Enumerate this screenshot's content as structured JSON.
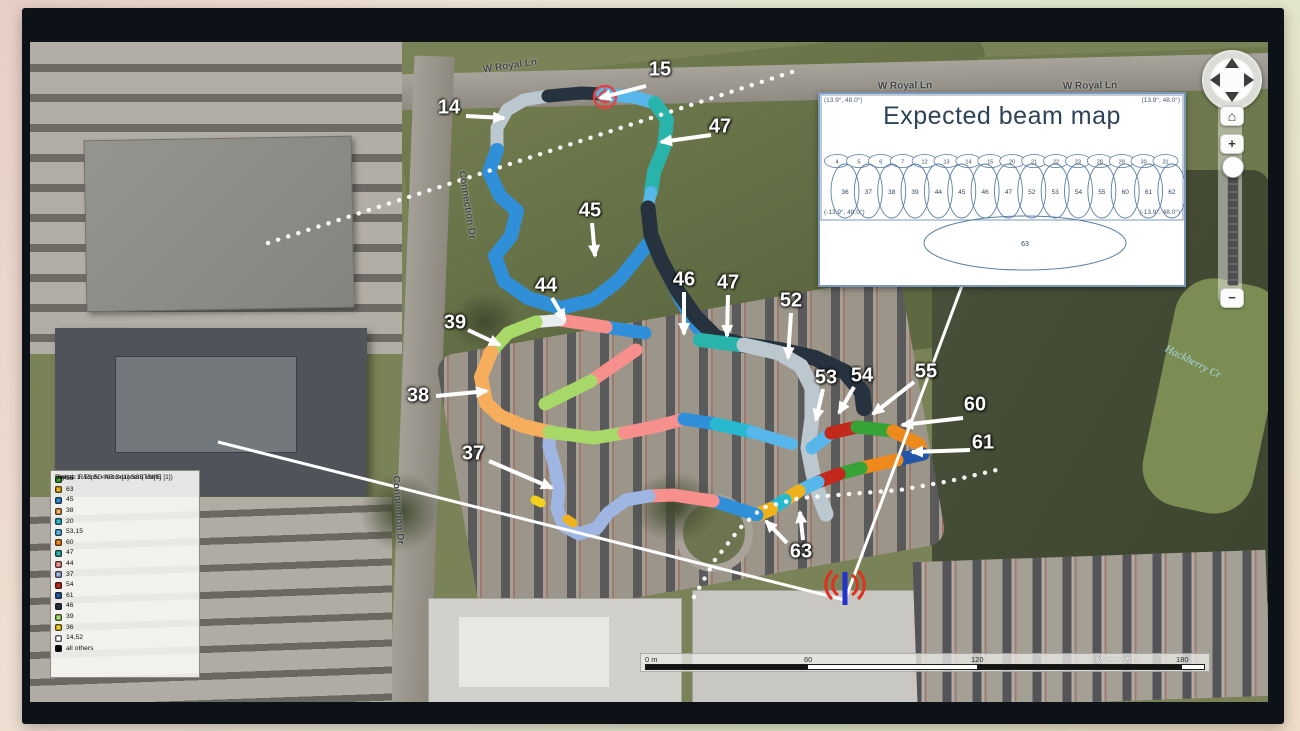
{
  "palette": {
    "b14_52": "#bcc8d0",
    "b15_53": "#58b7ea",
    "b45": "#2f8fd9",
    "b46": "#26323e",
    "b47": "#29b4ab",
    "b44": "#f78f8d",
    "b39": "#a8d968",
    "b38": "#f6ad5c",
    "b37": "#9fb6e3",
    "b54": "#c2291c",
    "b55": "#36a336",
    "b60": "#ee8a1b",
    "b61": "#2456a8",
    "b63": "#f0b21c",
    "b20": "#27b9d0",
    "b36": "#f2d21e",
    "white": "#e8edf0",
    "black": "#000000"
  },
  "legend": {
    "header_lines": [
      "Signal: 1. TopN <Auto>[1] SSB idx[1]",
      "Device: R&S 5G NR Scanner (TSME [1])",
      "Unit:"
    ],
    "entries": [
      {
        "label": "55",
        "color": "#36a336"
      },
      {
        "label": "63",
        "color": "#f0b21c"
      },
      {
        "label": "45",
        "color": "#2f8fd9"
      },
      {
        "label": "38",
        "color": "#f6ad5c"
      },
      {
        "label": "20",
        "color": "#27b9d0"
      },
      {
        "label": "53,15",
        "color": "#58b7ea"
      },
      {
        "label": "60",
        "color": "#ee8a1b"
      },
      {
        "label": "47",
        "color": "#29b4ab"
      },
      {
        "label": "44",
        "color": "#f78f8d"
      },
      {
        "label": "37",
        "color": "#9fb6e3"
      },
      {
        "label": "54",
        "color": "#c2291c"
      },
      {
        "label": "61",
        "color": "#2456a8"
      },
      {
        "label": "46",
        "color": "#26323e"
      },
      {
        "label": "39",
        "color": "#a8d968"
      },
      {
        "label": "36",
        "color": "#f2d21e"
      },
      {
        "label": "14,52",
        "color": "#ffffff"
      },
      {
        "label": "all others",
        "color": "#000000"
      }
    ]
  },
  "beam_map": {
    "title": "Expected beam map",
    "corner_labels": {
      "top_left": "(13.9°, 48.0°)",
      "top_right": "(13.9°, 48.0°)",
      "bottom_left": "(-13.9°, 48.0°)",
      "bottom_right": "(-13.9°, 48.0°)"
    },
    "row1": [
      "4",
      "5",
      "6",
      "7",
      "12",
      "13",
      "14",
      "15",
      "20",
      "21",
      "22",
      "23",
      "28",
      "29",
      "30",
      "31"
    ],
    "row2": [
      "36",
      "37",
      "38",
      "39",
      "44",
      "45",
      "46",
      "47",
      "52",
      "53",
      "54",
      "55",
      "60",
      "61",
      "62"
    ],
    "bottom_beam": "63"
  },
  "street_labels": [
    {
      "text": "W Royal Ln",
      "x": 480,
      "y": 24,
      "rot": -8,
      "style": ""
    },
    {
      "text": "W Royal Ln",
      "x": 875,
      "y": 44,
      "rot": -1,
      "style": ""
    },
    {
      "text": "W Royal Ln",
      "x": 1060,
      "y": 44,
      "rot": -1,
      "style": ""
    },
    {
      "text": "Connection Dr",
      "x": 437,
      "y": 163,
      "rot": 81,
      "style": ""
    },
    {
      "text": "Connection Dr",
      "x": 368,
      "y": 468,
      "rot": 86,
      "style": ""
    },
    {
      "text": "Hackberry Cr",
      "x": 1163,
      "y": 320,
      "rot": 27,
      "style": "creek"
    }
  ],
  "beam_labels": [
    {
      "text": "14",
      "x": 419,
      "y": 66,
      "arrows": [
        [
          436,
          74,
          474,
          76
        ]
      ]
    },
    {
      "text": "15",
      "x": 630,
      "y": 28,
      "arrows": [
        [
          616,
          44,
          570,
          56
        ]
      ]
    },
    {
      "text": "47",
      "x": 690,
      "y": 85,
      "arrows": [
        [
          681,
          93,
          631,
          100
        ]
      ]
    },
    {
      "text": "45",
      "x": 560,
      "y": 169,
      "arrows": [
        [
          562,
          181,
          565,
          214
        ]
      ]
    },
    {
      "text": "46",
      "x": 654,
      "y": 238,
      "arrows": [
        [
          654,
          250,
          654,
          292
        ]
      ]
    },
    {
      "text": "47",
      "x": 698,
      "y": 241,
      "arrows": [
        [
          698,
          253,
          697,
          294
        ]
      ]
    },
    {
      "text": "52",
      "x": 761,
      "y": 259,
      "arrows": [
        [
          761,
          271,
          758,
          316
        ]
      ]
    },
    {
      "text": "44",
      "x": 516,
      "y": 244,
      "arrows": [
        [
          522,
          256,
          535,
          278
        ]
      ]
    },
    {
      "text": "39",
      "x": 425,
      "y": 281,
      "arrows": [
        [
          438,
          288,
          470,
          303
        ]
      ]
    },
    {
      "text": "38",
      "x": 388,
      "y": 354,
      "arrows": [
        [
          406,
          354,
          457,
          349
        ]
      ]
    },
    {
      "text": "37",
      "x": 443,
      "y": 412,
      "arrows": [
        [
          459,
          419,
          522,
          446
        ]
      ]
    },
    {
      "text": "53",
      "x": 796,
      "y": 336,
      "arrows": [
        [
          793,
          347,
          786,
          378
        ]
      ]
    },
    {
      "text": "54",
      "x": 832,
      "y": 334,
      "arrows": [
        [
          824,
          345,
          809,
          371
        ]
      ]
    },
    {
      "text": "55",
      "x": 896,
      "y": 330,
      "arrows": [
        [
          884,
          340,
          843,
          372
        ]
      ]
    },
    {
      "text": "60",
      "x": 945,
      "y": 363,
      "arrows": [
        [
          933,
          376,
          872,
          383
        ]
      ]
    },
    {
      "text": "61",
      "x": 953,
      "y": 401,
      "arrows": [
        [
          940,
          408,
          882,
          410
        ]
      ]
    },
    {
      "text": "63",
      "x": 771,
      "y": 510,
      "arrows": [
        [
          757,
          501,
          736,
          479
        ],
        [
          773,
          498,
          770,
          470
        ]
      ]
    }
  ],
  "route_segments": [
    {
      "beam": "14",
      "c": "b14_52",
      "w": 13,
      "pts": [
        [
          467,
          108
        ],
        [
          467,
          86
        ],
        [
          477,
          68
        ],
        [
          494,
          58
        ],
        [
          518,
          54
        ]
      ]
    },
    {
      "beam": "46",
      "c": "b46",
      "w": 13,
      "pts": [
        [
          518,
          54
        ],
        [
          552,
          51
        ],
        [
          572,
          52
        ]
      ]
    },
    {
      "beam": "15",
      "c": "b15_53",
      "w": 13,
      "pts": [
        [
          572,
          52
        ],
        [
          604,
          55
        ],
        [
          625,
          61
        ]
      ]
    },
    {
      "beam": "47",
      "c": "b47",
      "w": 14,
      "pts": [
        [
          625,
          61
        ],
        [
          637,
          78
        ],
        [
          634,
          105
        ],
        [
          624,
          130
        ],
        [
          621,
          150
        ]
      ]
    },
    {
      "beam": "15",
      "c": "b15_53",
      "w": 12,
      "pts": [
        [
          621,
          150
        ],
        [
          618,
          164
        ]
      ]
    },
    {
      "beam": "45",
      "c": "b45",
      "w": 14,
      "pts": [
        [
          467,
          108
        ],
        [
          459,
          130
        ],
        [
          470,
          154
        ],
        [
          487,
          169
        ],
        [
          481,
          194
        ],
        [
          465,
          214
        ],
        [
          474,
          239
        ],
        [
          498,
          256
        ],
        [
          531,
          266
        ],
        [
          563,
          258
        ],
        [
          588,
          239
        ],
        [
          606,
          217
        ],
        [
          621,
          198
        ]
      ]
    },
    {
      "beam": "45",
      "c": "b45",
      "w": 14,
      "pts": [
        [
          621,
          198
        ],
        [
          635,
          226
        ],
        [
          651,
          258
        ],
        [
          668,
          286
        ],
        [
          684,
          298
        ]
      ]
    },
    {
      "beam": "46",
      "c": "b46",
      "w": 15,
      "pts": [
        [
          618,
          166
        ],
        [
          621,
          193
        ],
        [
          631,
          218
        ],
        [
          647,
          248
        ],
        [
          666,
          275
        ],
        [
          686,
          295
        ],
        [
          714,
          303
        ]
      ]
    },
    {
      "beam": "46",
      "c": "b46",
      "w": 16,
      "pts": [
        [
          714,
          303
        ],
        [
          750,
          308
        ],
        [
          785,
          316
        ],
        [
          815,
          330
        ],
        [
          832,
          350
        ],
        [
          834,
          366
        ]
      ]
    },
    {
      "beam": "47",
      "c": "b47",
      "w": 14,
      "pts": [
        [
          670,
          298
        ],
        [
          710,
          303
        ]
      ]
    },
    {
      "beam": "52",
      "c": "b14_52",
      "w": 15,
      "pts": [
        [
          714,
          303
        ],
        [
          749,
          311
        ],
        [
          771,
          324
        ],
        [
          782,
          346
        ],
        [
          782,
          376
        ],
        [
          778,
          406
        ],
        [
          783,
          432
        ],
        [
          790,
          456
        ],
        [
          796,
          472
        ]
      ]
    },
    {
      "beam": "53",
      "c": "b15_53",
      "w": 13,
      "pts": [
        [
          782,
          406
        ],
        [
          801,
          391
        ]
      ]
    },
    {
      "beam": "54",
      "c": "b54",
      "w": 13,
      "pts": [
        [
          801,
          391
        ],
        [
          827,
          385
        ]
      ]
    },
    {
      "beam": "55",
      "c": "b55",
      "w": 13,
      "pts": [
        [
          827,
          385
        ],
        [
          863,
          389
        ]
      ]
    },
    {
      "beam": "60",
      "c": "b60",
      "w": 13,
      "pts": [
        [
          863,
          389
        ],
        [
          889,
          402
        ],
        [
          893,
          412
        ]
      ]
    },
    {
      "beam": "61",
      "c": "b61",
      "w": 13,
      "pts": [
        [
          893,
          412
        ],
        [
          867,
          418
        ]
      ]
    },
    {
      "beam": "60",
      "c": "b60",
      "w": 13,
      "pts": [
        [
          867,
          418
        ],
        [
          831,
          426
        ]
      ]
    },
    {
      "beam": "55",
      "c": "b55",
      "w": 13,
      "pts": [
        [
          831,
          426
        ],
        [
          809,
          432
        ]
      ]
    },
    {
      "beam": "54",
      "c": "b54",
      "w": 13,
      "pts": [
        [
          809,
          432
        ],
        [
          788,
          440
        ]
      ]
    },
    {
      "beam": "53",
      "c": "b15_53",
      "w": 13,
      "pts": [
        [
          788,
          440
        ],
        [
          769,
          449
        ]
      ]
    },
    {
      "beam": "63",
      "c": "b63",
      "w": 13,
      "pts": [
        [
          769,
          449
        ],
        [
          755,
          458
        ]
      ]
    },
    {
      "beam": "20",
      "c": "b20",
      "w": 13,
      "pts": [
        [
          755,
          458
        ],
        [
          741,
          467
        ]
      ]
    },
    {
      "beam": "63",
      "c": "b63",
      "w": 14,
      "pts": [
        [
          741,
          467
        ],
        [
          727,
          473
        ]
      ]
    },
    {
      "beam": "45",
      "c": "b45",
      "w": 13,
      "pts": [
        [
          727,
          473
        ],
        [
          699,
          464
        ],
        [
          683,
          459
        ]
      ]
    },
    {
      "beam": "44",
      "c": "b44",
      "w": 13,
      "pts": [
        [
          683,
          459
        ],
        [
          643,
          453
        ],
        [
          619,
          454
        ]
      ]
    },
    {
      "beam": "37",
      "c": "b37",
      "w": 13,
      "pts": [
        [
          619,
          454
        ],
        [
          596,
          458
        ],
        [
          578,
          471
        ],
        [
          567,
          486
        ],
        [
          549,
          492
        ],
        [
          534,
          484
        ],
        [
          527,
          467
        ],
        [
          529,
          447
        ],
        [
          525,
          425
        ],
        [
          519,
          404
        ],
        [
          520,
          389
        ]
      ]
    },
    {
      "beam": "45",
      "c": "b45",
      "w": 13,
      "pts": [
        [
          615,
          291
        ],
        [
          576,
          285
        ]
      ]
    },
    {
      "beam": "44",
      "c": "b44",
      "w": 13,
      "pts": [
        [
          576,
          285
        ],
        [
          530,
          278
        ]
      ]
    },
    {
      "beam": "14",
      "c": "white",
      "w": 12,
      "pts": [
        [
          530,
          278
        ],
        [
          506,
          280
        ]
      ]
    },
    {
      "beam": "39",
      "c": "b39",
      "w": 13,
      "pts": [
        [
          506,
          280
        ],
        [
          478,
          291
        ],
        [
          461,
          310
        ]
      ]
    },
    {
      "beam": "38",
      "c": "b38",
      "w": 14,
      "pts": [
        [
          461,
          310
        ],
        [
          451,
          335
        ],
        [
          456,
          361
        ],
        [
          470,
          374
        ],
        [
          493,
          384
        ],
        [
          519,
          390
        ]
      ]
    },
    {
      "beam": "39",
      "c": "b39",
      "w": 13,
      "pts": [
        [
          519,
          390
        ],
        [
          564,
          396
        ]
      ]
    },
    {
      "beam": "39",
      "c": "b39",
      "w": 13,
      "pts": [
        [
          564,
          396
        ],
        [
          594,
          391
        ]
      ]
    },
    {
      "beam": "44",
      "c": "b44",
      "w": 13,
      "pts": [
        [
          594,
          391
        ],
        [
          628,
          384
        ],
        [
          654,
          377
        ]
      ]
    },
    {
      "beam": "45",
      "c": "b45",
      "w": 13,
      "pts": [
        [
          654,
          377
        ],
        [
          686,
          382
        ]
      ]
    },
    {
      "beam": "20",
      "c": "b20",
      "w": 13,
      "pts": [
        [
          686,
          382
        ],
        [
          722,
          390
        ]
      ]
    },
    {
      "beam": "15",
      "c": "b15_53",
      "w": 12,
      "pts": [
        [
          722,
          390
        ],
        [
          762,
          402
        ]
      ]
    },
    {
      "beam": "44",
      "c": "b44",
      "w": 13,
      "pts": [
        [
          606,
          308
        ],
        [
          561,
          339
        ]
      ]
    },
    {
      "beam": "39",
      "c": "b39",
      "w": 13,
      "pts": [
        [
          561,
          339
        ],
        [
          515,
          362
        ]
      ]
    },
    {
      "beam": "63",
      "c": "b63",
      "w": 9,
      "pts": [
        [
          537,
          477
        ],
        [
          543,
          481
        ]
      ]
    },
    {
      "beam": "36",
      "c": "b36",
      "w": 9,
      "pts": [
        [
          505,
          458
        ],
        [
          511,
          461
        ]
      ]
    }
  ],
  "overlay_lines": {
    "solid": [
      [
        188,
        400,
        815,
        558
      ],
      [
        815,
        558,
        933,
        241
      ]
    ],
    "dotted": [
      {
        "pts": [
          [
            238,
            201
          ],
          [
            765,
            29
          ]
        ]
      },
      {
        "pts": [
          [
            664,
            555
          ],
          [
            685,
            518
          ],
          [
            710,
            486
          ],
          [
            732,
            466
          ],
          [
            770,
            456
          ],
          [
            820,
            452
          ],
          [
            870,
            448
          ],
          [
            920,
            439
          ],
          [
            975,
            426
          ]
        ]
      }
    ]
  },
  "markers": {
    "start": {
      "x": 575,
      "y": 55
    },
    "antenna": {
      "x": 815,
      "y": 545
    }
  },
  "scale_bar": {
    "unit_labels": [
      {
        "text": "0 m",
        "x": 4
      },
      {
        "text": "60",
        "x": 163
      },
      {
        "text": "120",
        "x": 330
      },
      {
        "text": "180",
        "x": 535
      }
    ],
    "segments": [
      {
        "x": 4,
        "w": 162,
        "color": "#141414"
      },
      {
        "x": 166,
        "w": 171,
        "color": "#fdfdfb"
      },
      {
        "x": 337,
        "w": 203,
        "color": "#141414"
      },
      {
        "x": 540,
        "w": 24,
        "color": "#fdfdfb"
      }
    ],
    "watermark": "Microsoft"
  },
  "nav": {
    "home_glyph": "⌂",
    "zoom_in": "+",
    "zoom_out": "−"
  }
}
